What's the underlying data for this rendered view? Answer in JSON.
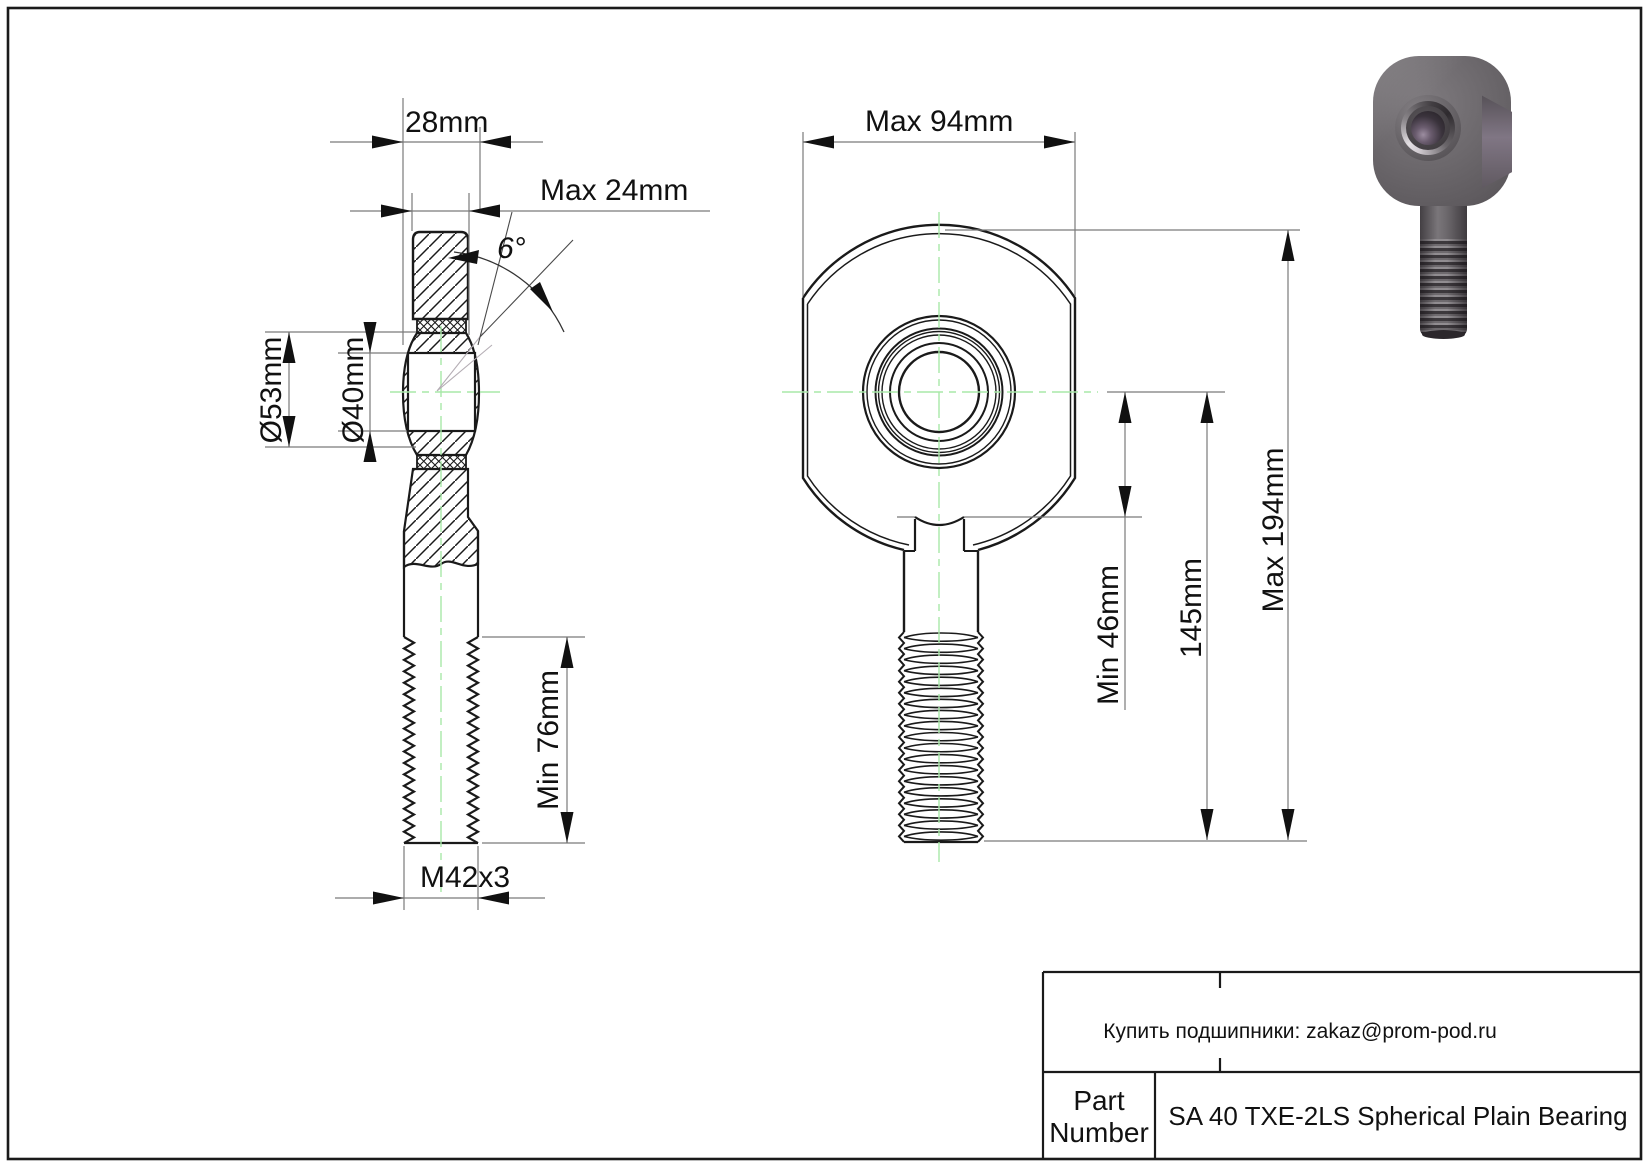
{
  "side_view": {
    "ball_width": "28mm",
    "head_width": "Max 24mm",
    "misalignment_angle": "6°",
    "outer_diameter": "Ø53mm",
    "bore_diameter": "Ø40mm",
    "thread_min_length": "Min 76mm",
    "thread_spec": "M42x3"
  },
  "front_view": {
    "head_width": "Max 94mm",
    "shank_min_length": "Min 46mm",
    "center_to_end": "145mm",
    "total_length": "Max 194mm"
  },
  "title_block": {
    "contact": "Купить подшипники: zakaz@prom-pod.ru",
    "part_label_line1": "Part",
    "part_label_line2": "Number",
    "part_number": "SA 40 TXE-2LS Spherical Plain Bearing"
  },
  "colors": {
    "line": "#1a1a1a",
    "dim_line": "#7a7a7a",
    "centerline": "#a8e8a8",
    "render_body_gray": "#6b676b"
  }
}
